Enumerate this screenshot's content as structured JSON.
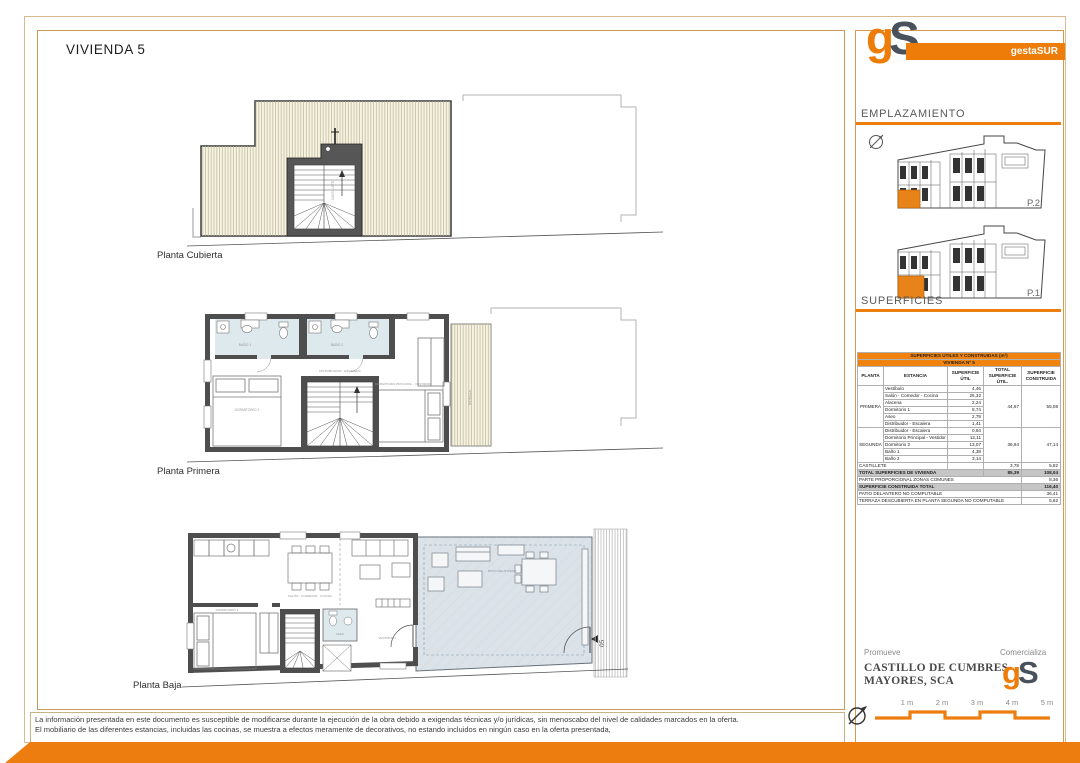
{
  "page": {
    "title": "VIVIENDA 5"
  },
  "brand": {
    "logo_g": "g",
    "logo_s": "S",
    "name": "gestaSUR"
  },
  "sections": {
    "emplazamiento": "EMPLAZAMIENTO",
    "superficies": "SUPERFICIES"
  },
  "site": {
    "p2": "P.2",
    "p1": "P.1"
  },
  "plans": {
    "cubierta": {
      "label": "Planta Cubierta",
      "stair_label": "CASTILLETE"
    },
    "primera": {
      "label": "Planta Primera",
      "rooms": {
        "bano1": "BAÑO 1",
        "bano2": "BAÑO 2",
        "dorm2": "DORMITORIO 2",
        "distribuidor": "DISTRIBUIDOR - ESCALERA",
        "dormp": "DORMITORIO PRINCIPAL - VESTIDOR",
        "terraza": "TERRAZA"
      }
    },
    "baja": {
      "label": "Planta Baja",
      "rooms": {
        "salon": "SALÓN - COMEDOR - COCINA",
        "dorm1": "DORMITORIO 1",
        "aseo": "ASEO",
        "vestibulo": "VESTÍBULO",
        "patio": "PATIO DELANTERO",
        "num": "05"
      }
    }
  },
  "table": {
    "header1": "SUPERFICIES ÚTILES Y CONSTRUIDAS (m²)",
    "header2": "VIVIENDA Nº 5",
    "cols": {
      "planta": "PLANTA",
      "estancia": "ESTANCIA",
      "util": "SUPERFICIE ÚTIL",
      "total": "TOTAL SUPERFICIE ÚTIL.",
      "construida": "SUPERFICIE CONSTRUIDA"
    },
    "primera_label": "PRIMERA",
    "primera_rooms": [
      {
        "name": "Vestíbulo",
        "value": "4,46"
      },
      {
        "name": "Salón - Comedor - Cocina",
        "value": "25,32"
      },
      {
        "name": "Alacena",
        "value": "2,24"
      },
      {
        "name": "Dormitorio 1",
        "value": "8,74"
      },
      {
        "name": "Aseo",
        "value": "2,78"
      },
      {
        "name": "Distribuidor - Escalera",
        "value": "1,41"
      }
    ],
    "primera_total": "44,67",
    "primera_construida": "55,08",
    "segunda_label": "SEGUNDA",
    "segunda_rooms": [
      {
        "name": "Distribuidor - Escalera",
        "value": "0,64"
      },
      {
        "name": "Dormitorio Principal - Vestidor",
        "value": "12,11"
      },
      {
        "name": "Dormitorio 2",
        "value": "13,07"
      },
      {
        "name": "Baño 1",
        "value": "4,38"
      },
      {
        "name": "Baño 2",
        "value": "3,14"
      }
    ],
    "segunda_total": "36,94",
    "segunda_construida": "47,14",
    "castillete_label": "CASTILLETE",
    "castillete_total": "3,78",
    "castillete_construida": "5,82",
    "summary": [
      {
        "label": "TOTAL SUPERFICIES DE VIVIENDA",
        "total": "85,39",
        "construida": "108,04"
      },
      {
        "label": "PARTE PROPORCIONAL ZONAS COMUNES",
        "construida": "8,36"
      },
      {
        "label": "SUPERFICIE CONSTRUIDA TOTAL",
        "construida": "116,40"
      },
      {
        "label": "PATIO DELANTERO NO COMPUTABLE",
        "construida": "36,41"
      },
      {
        "label": "TERRAZA DESCUBIERTA EN PLANTA SEGUNDA NO COMPUTABLE",
        "construida": "5,62"
      }
    ]
  },
  "footer": {
    "promueve_label": "Promueve",
    "promueve_name_line1": "CASTILLO DE CUMBRES",
    "promueve_name_line2": "MAYORES, SCA",
    "comercializa_label": "Comercializa",
    "scale": [
      "1 m",
      "2 m",
      "3 m",
      "4 m",
      "5 m"
    ]
  },
  "disclaimer": {
    "line1": "La información presentada en este documento es susceptible de modificarse durante la ejecución de la obra debido a exigendas técnicas y/o jurídicas, sin menoscabo del nivel de calidades marcados en la oferta.",
    "line2": "El mobiliario de las diferentes estancias, incluidas las cocinas, se muestra a efectos meramente de decorativos, no estando incluidos en ningún caso en la oferta presentada,"
  },
  "colors": {
    "accent": "#ED7D0E",
    "slate": "#49525C",
    "highlight_unit": "#E8831A"
  }
}
